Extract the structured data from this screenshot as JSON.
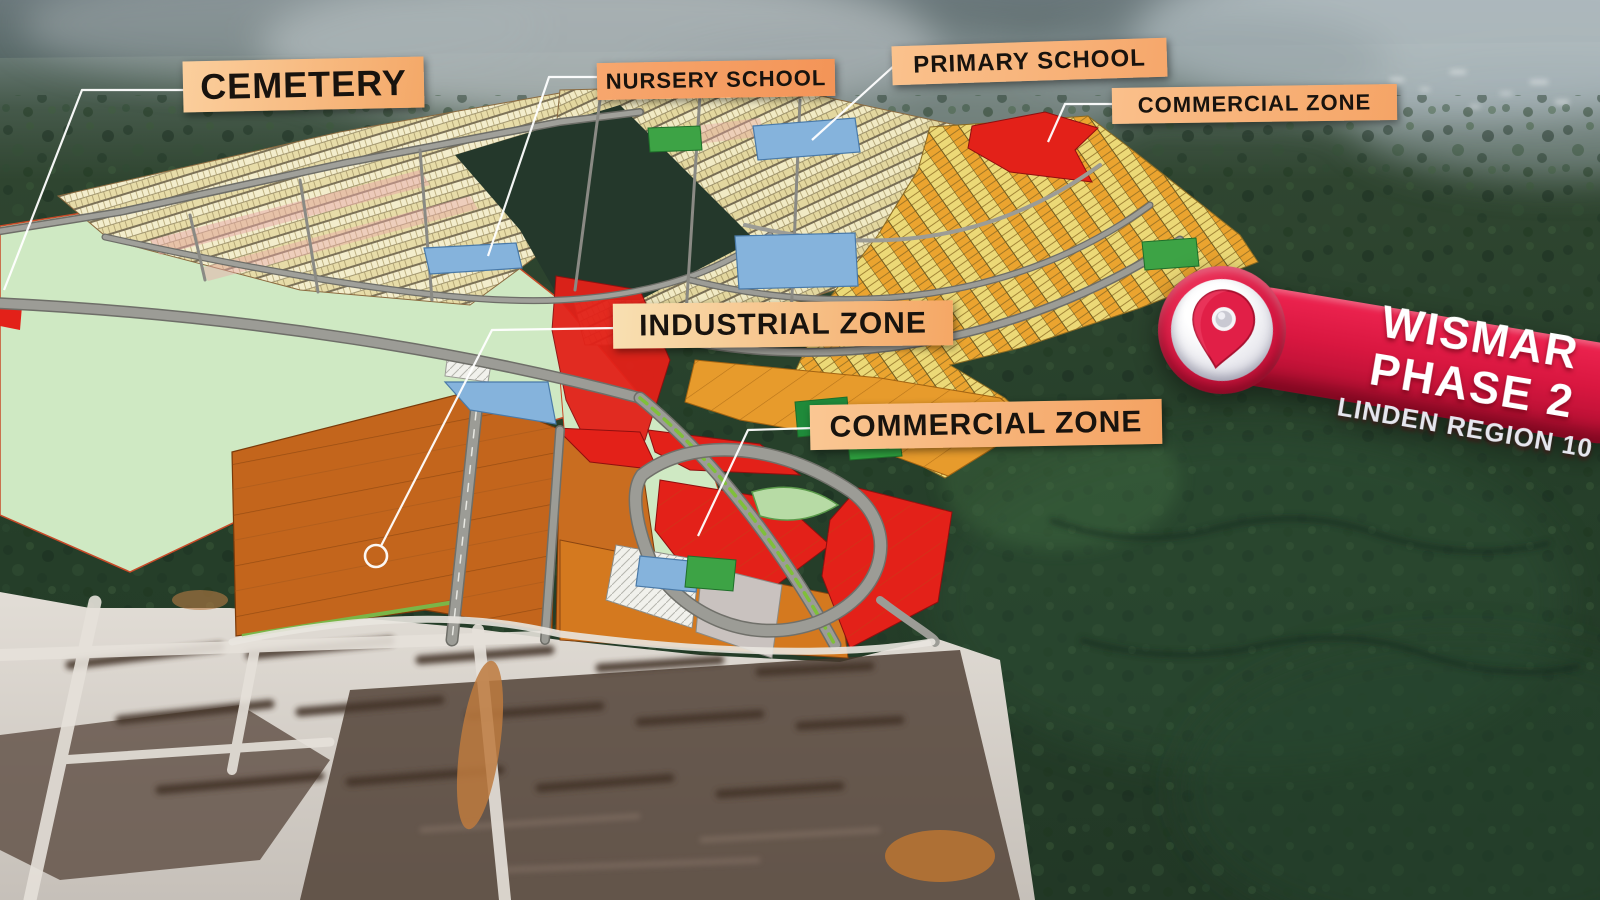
{
  "scene": {
    "description": "Aerial drone photo of forested land with a master-plan zoning overlay",
    "project_area": "Wismar Phase 2 housing scheme master plan"
  },
  "annotations": {
    "labels": [
      {
        "id": "cemetery",
        "text": "CEMETERY"
      },
      {
        "id": "nursery_school",
        "text": "NURSERY SCHOOL"
      },
      {
        "id": "primary_school",
        "text": "PRIMARY SCHOOL"
      },
      {
        "id": "commercial_zone_north",
        "text": "COMMERCIAL ZONE"
      },
      {
        "id": "industrial_zone",
        "text": "INDUSTRIAL ZONE"
      },
      {
        "id": "commercial_zone_central",
        "text": "COMMERCIAL ZONE"
      }
    ]
  },
  "location_badge": {
    "project": "WISMAR",
    "phase": "PHASE 2",
    "region": "LINDEN REGION 10",
    "icon": "map-pin-icon"
  },
  "colors": {
    "label_background": "#f6ae72",
    "label_text": "#18130e",
    "badge_red": "#d91740",
    "cemetery_green": "#cfe9c3",
    "school_blue": "#85b3dc",
    "park_green": "#3da345",
    "commercial_red": "#e32119",
    "industrial_orange": "#c3651c",
    "residential_cream": "#eee6bc",
    "road_gray": "#9c9c96",
    "leader_line": "#ffffff"
  }
}
